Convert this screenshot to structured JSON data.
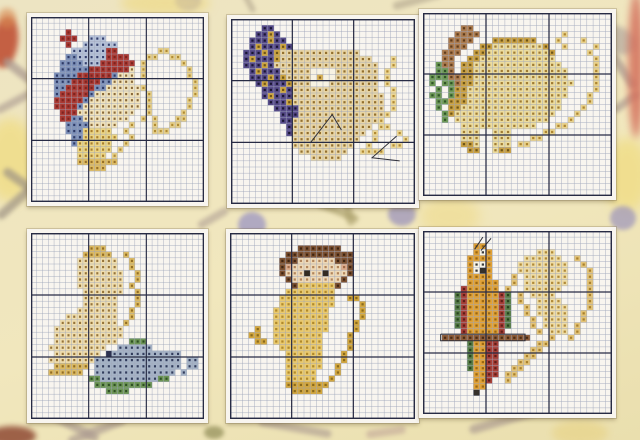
{
  "chart_style": {
    "paper": "#f8f5ef",
    "grid_thin": "#9aa2b8",
    "grid_thick": "#272b44",
    "backstitch": "#2f2f38"
  },
  "background": {
    "shapes": [
      {
        "kind": "ellipse",
        "x": -8,
        "y": 16,
        "w": 26,
        "h": 52,
        "rot": 8,
        "color": "#c05236",
        "op": 0.9,
        "blur": 3
      },
      {
        "kind": "ellipse",
        "x": -2,
        "y": 8,
        "w": 18,
        "h": 20,
        "rot": 0,
        "color": "#d88a52",
        "op": 0.6,
        "blur": 3
      },
      {
        "kind": "bar",
        "x": 0,
        "y": 66,
        "w": 36,
        "h": 9,
        "rot": 38,
        "color": "#a9988f",
        "op": 0.7,
        "blur": 2
      },
      {
        "kind": "bar",
        "x": -6,
        "y": 98,
        "w": 40,
        "h": 8,
        "rot": -28,
        "color": "#a9988f",
        "op": 0.6,
        "blur": 2
      },
      {
        "kind": "ellipse",
        "x": -16,
        "y": 118,
        "w": 52,
        "h": 84,
        "rot": 0,
        "color": "#f0dd85",
        "op": 0.8,
        "blur": 6
      },
      {
        "kind": "bar",
        "x": 0,
        "y": 178,
        "w": 44,
        "h": 9,
        "rot": 35,
        "color": "#9f9484",
        "op": 0.7,
        "blur": 2
      },
      {
        "kind": "bar",
        "x": -8,
        "y": 198,
        "w": 46,
        "h": 9,
        "rot": -42,
        "color": "#9f9484",
        "op": 0.7,
        "blur": 2
      },
      {
        "kind": "ellipse",
        "x": 175,
        "y": -8,
        "w": 26,
        "h": 18,
        "rot": 0,
        "color": "#9c94bb",
        "op": 0.8,
        "blur": 2
      },
      {
        "kind": "bar",
        "x": 232,
        "y": -4,
        "w": 30,
        "h": 6,
        "rot": 62,
        "color": "#b0a48c",
        "op": 0.6,
        "blur": 2
      },
      {
        "kind": "bar",
        "x": 392,
        "y": -4,
        "w": 52,
        "h": 8,
        "rot": -15,
        "color": "#b0a48c",
        "op": 0.6,
        "blur": 2
      },
      {
        "kind": "ellipse",
        "x": 120,
        "y": -10,
        "w": 90,
        "h": 26,
        "rot": 0,
        "color": "#eeda88",
        "op": 0.7,
        "blur": 5
      },
      {
        "kind": "ellipse",
        "x": 238,
        "y": 212,
        "w": 28,
        "h": 26,
        "rot": 0,
        "color": "#a19ac2",
        "op": 0.8,
        "blur": 2
      },
      {
        "kind": "ellipse",
        "x": 388,
        "y": 202,
        "w": 28,
        "h": 24,
        "rot": 0,
        "color": "#9c94bb",
        "op": 0.75,
        "blur": 2
      },
      {
        "kind": "bar",
        "x": 316,
        "y": 208,
        "w": 44,
        "h": 7,
        "rot": 22,
        "color": "#aba06c",
        "op": 0.65,
        "blur": 2
      },
      {
        "kind": "bar",
        "x": 344,
        "y": 194,
        "w": 8,
        "h": 32,
        "rot": -14,
        "color": "#aba06c",
        "op": 0.6,
        "blur": 2
      },
      {
        "kind": "bar",
        "x": 196,
        "y": 214,
        "w": 34,
        "h": 8,
        "rot": -30,
        "color": "#a9988f",
        "op": 0.55,
        "blur": 2
      },
      {
        "kind": "ellipse",
        "x": 420,
        "y": 196,
        "w": 60,
        "h": 40,
        "rot": 0,
        "color": "#eeda88",
        "op": 0.55,
        "blur": 6
      },
      {
        "kind": "ellipse",
        "x": 594,
        "y": 26,
        "w": 44,
        "h": 28,
        "rot": 18,
        "color": "#b0a49c",
        "op": 0.65,
        "blur": 3
      },
      {
        "kind": "bar",
        "x": 602,
        "y": 66,
        "w": 42,
        "h": 9,
        "rot": 55,
        "color": "#a9988f",
        "op": 0.7,
        "blur": 2
      },
      {
        "kind": "bar",
        "x": 610,
        "y": 98,
        "w": 32,
        "h": 8,
        "rot": -35,
        "color": "#a9988f",
        "op": 0.65,
        "blur": 2
      },
      {
        "kind": "ellipse",
        "x": 604,
        "y": 138,
        "w": 46,
        "h": 74,
        "rot": 0,
        "color": "#f0dd85",
        "op": 0.8,
        "blur": 6
      },
      {
        "kind": "ellipse",
        "x": 610,
        "y": 206,
        "w": 26,
        "h": 24,
        "rot": 0,
        "color": "#9c94bb",
        "op": 0.7,
        "blur": 2
      },
      {
        "kind": "ellipse",
        "x": 628,
        "y": -8,
        "w": 16,
        "h": 146,
        "rot": 0,
        "color": "#d4705c",
        "op": 0.85,
        "blur": 4
      },
      {
        "kind": "ellipse",
        "x": -12,
        "y": 426,
        "w": 48,
        "h": 20,
        "rot": 0,
        "color": "#8f4a34",
        "op": 0.85,
        "blur": 3
      },
      {
        "kind": "bar",
        "x": 38,
        "y": 420,
        "w": 64,
        "h": 9,
        "rot": 28,
        "color": "#a9988f",
        "op": 0.65,
        "blur": 2
      },
      {
        "kind": "bar",
        "x": 66,
        "y": 426,
        "w": 62,
        "h": 9,
        "rot": -22,
        "color": "#a9988f",
        "op": 0.65,
        "blur": 2
      },
      {
        "kind": "ellipse",
        "x": 204,
        "y": 426,
        "w": 20,
        "h": 13,
        "rot": 0,
        "color": "#95915c",
        "op": 0.75,
        "blur": 2
      },
      {
        "kind": "bar",
        "x": 258,
        "y": 424,
        "w": 74,
        "h": 8,
        "rot": 10,
        "color": "#a9988f",
        "op": 0.6,
        "blur": 2
      },
      {
        "kind": "bar",
        "x": 366,
        "y": 428,
        "w": 40,
        "h": 8,
        "rot": -8,
        "color": "#b89a92",
        "op": 0.5,
        "blur": 2
      },
      {
        "kind": "bar",
        "x": 468,
        "y": 416,
        "w": 72,
        "h": 9,
        "rot": -16,
        "color": "#a9988f",
        "op": 0.65,
        "blur": 2
      },
      {
        "kind": "ellipse",
        "x": 552,
        "y": 420,
        "w": 56,
        "h": 26,
        "rot": 0,
        "color": "#e8d48a",
        "op": 0.7,
        "blur": 4
      }
    ]
  },
  "panels": [
    {
      "subject": "red-and-blue-bird-with-golden-swirl",
      "cols": 30,
      "rows": 30,
      "box": {
        "left": 27,
        "top": 13,
        "width": 181,
        "height": 193
      },
      "palette": {
        "r": {
          "c": "#ab3a33",
          "s": "#7c2420"
        },
        "l": {
          "c": "#b6c2d8",
          "s": "#35406e"
        },
        "b": {
          "c": "#7d90b8",
          "s": "#2e3a66"
        },
        "c": {
          "c": "#f2e4bc",
          "s": "#8a6a3a"
        },
        "y": {
          "c": "#ecd584",
          "s": "#a87f2e"
        },
        "g": {
          "c": "#e6cf8a",
          "s": "#b08b33"
        },
        "f": {
          "c": "#dfbc62",
          "s": "#97702a"
        }
      },
      "grid": [
        "..............................",
        "..............................",
        "......r.......................",
        ".....rrr..lll.................",
        "......r..llllll...............",
        ".......llllllrr.......gg......",
        "......bblllllrrrr...gg..gg....",
        ".....bbbblllrrrrrr.g......g...",
        ".....bbbbbrrrrrrrc.g.......g..",
        "....bbbbrrrrrrbccc.g.......g..",
        "....bbbrrrrrbbcccc..........g.",
        "....bbrrrrrbbccccccg........g.",
        "....brrrrrbcccccccc.g.......g.",
        "....rrrrrbccccccccc.g......g..",
        "....rrrrbcccccccccc.g......g..",
        ".....rrrcccccccccc..g.....g...",
        ".....rrbbcccccccc..g.g...gg...",
        "......bbbbccccc..g...g..gg....",
        "......bbbyyyyy..g....ggg......",
        ".......bbyyyyyy..g............",
        ".......byyyyyy..g.............",
        "........yyyyyy.g..............",
        "........yyyyy.g...............",
        "........fffffff...............",
        "..........fff.................",
        "..............................",
        "..............................",
        "..............................",
        "..............................",
        ".............................."
      ],
      "backstitch": []
    },
    {
      "subject": "purple-headed-fish",
      "cols": 30,
      "rows": 30,
      "box": {
        "left": 227,
        "top": 15,
        "width": 192,
        "height": 193
      },
      "palette": {
        "p": {
          "c": "#564a88",
          "s": "#191633"
        },
        "a": {
          "c": "#cda43f",
          "s": "#6e5517"
        },
        "e": {
          "c": "#e9d6a6",
          "s": "#93702f"
        },
        "o": {
          "c": "#ecd795",
          "s": "#b18a34"
        },
        "w": {
          "c": "#f7f2e2",
          "s": null
        },
        "d": {
          "c": "#d9b254",
          "s": "#8a6420"
        }
      },
      "grid": [
        "..............................",
        ".....pp.......................",
        "....ppap......................",
        "...pppapp.....................",
        "...papppap....................",
        "..pppapaeeeeeeeeeeeee.........",
        "..papppaeeeeeeeeeeeeeee...o...",
        "..pppapeeeeeeeeeeeeeeeee..o...",
        "...papppeeeeewwwweeeeeee.o....",
        "...pppapaeeeewdwweeeeeee.o....",
        "....papppaeeewwweeeeeeee.o....",
        ".....pppapeeeeeeeeeeeeee..o...",
        ".....papppeeeeeeeeeeeeeee.o...",
        "......pppaeeeeeeeeeeeeeee.o...",
        ".......ppppeeeeeeeeeeeeee.o...",
        "........pppeeeeeeeeeeeeeeo....",
        "........ppeeeeeeeeeeeeeeo.....",
        ".........peeeeeeeeeeeee.oo....",
        ".........peeeeeeeeeeee.o...o..",
        "..........eeeeeeeeeee..o....o.",
        "..........eeeeeeeeee..o...oo..",
        "...........eeeeeeee..oooo.....",
        ".............eeeee............",
        "..............................",
        "..............................",
        "..............................",
        "..............................",
        "..............................",
        "..............................",
        ".............................."
      ],
      "backstitch": [
        [
          [
            13,
            20
          ],
          [
            16.5,
            15.5
          ],
          [
            18,
            18
          ]
        ],
        [
          [
            27,
            19
          ],
          [
            23,
            22.5
          ],
          [
            27.5,
            23
          ]
        ]
      ]
    },
    {
      "subject": "grazing-animal-with-green-plant-and-swirl",
      "cols": 30,
      "rows": 30,
      "box": {
        "left": 419,
        "top": 9,
        "width": 197,
        "height": 191
      },
      "palette": {
        "m": {
          "c": "#ad7c4e",
          "s": "#5f3c1c"
        },
        "d": {
          "c": "#caa143",
          "s": "#6e5517"
        },
        "h": {
          "c": "#ecdc9e",
          "s": "#a07c33"
        },
        "g": {
          "c": "#6f9a58",
          "s": "#2f5426"
        },
        "o": {
          "c": "#e9d28d",
          "s": "#ad8530"
        }
      },
      "grid": [
        "..............................",
        "..............................",
        "......mm......................",
        ".....mmmm.............o.......",
        "....mmmm...ddddddd...o...o....",
        "....mmm..ddhhhhhhhhd..o....o..",
        "...mmm..ddhhhhhhhhhhd.....o...",
        "...mm..ddhhhhhhhhhhhh......o..",
        "..gmm.ddhhhhhhhhhhhhhh.....o..",
        "..ggm.ddhhhhhhhhhhhhhhh....o..",
        ".gggmmddhhhhhhhhhhhhhhh....o..",
        ".g.ggmddhhhhhhhhhhhhhhhh...o..",
        "..g.gddhhhhhhhhhhhhhhhh....o..",
        ".gg.gddhhhhhhhhhhhhhhhh...o...",
        "..ggdddhhhhhhhhhhhhhhh....o...",
        "..g.ddhhhhhhhhhhhhhhhh...o....",
        "...gdhhhhhhhhhhhhhhhh...o.....",
        "...g.hhhhhhhhhhhhhhh...o......",
        "......hhhhhhhhhhhh...oo.......",
        "......hhh..hhh.....oo.........",
        "......hhh..hhh...oo...........",
        "......ddh..hhh.oo.............",
        ".......dd..hdd................",
        "..............................",
        "..............................",
        "..............................",
        "..............................",
        "..............................",
        "..............................",
        ".............................."
      ],
      "backstitch": []
    },
    {
      "subject": "cream-bird-with-blue-fish-on-green-weed",
      "cols": 30,
      "rows": 30,
      "box": {
        "left": 27,
        "top": 229,
        "width": 181,
        "height": 194
      },
      "palette": {
        "c": {
          "c": "#f0deae",
          "s": "#96743a"
        },
        "d": {
          "c": "#dcba62",
          "s": "#926d24"
        },
        "s": {
          "c": "#a5b3c6",
          "s": "#323c5c"
        },
        "g": {
          "c": "#6d9556",
          "s": "#2e4f24"
        },
        "w": {
          "c": "#f8f6ee",
          "s": null
        },
        "k": {
          "c": "#2c3150",
          "s": null
        }
      },
      "grid": [
        "..............................",
        "..............................",
        "..........ddd.................",
        ".........ddddd..d.............",
        "........ccccccc..d............",
        "........ccccccc..d............",
        "........cccccccc..d...........",
        "........cccccccc..d...........",
        "........cccccccc.d............",
        ".........ccccccc..d...........",
        ".........cccccc...d...........",
        ".........cccccc...d...........",
        "........ccccccc..d............",
        "......ccccccccc..d............",
        ".....cccccccccc.d.............",
        "....cccccccccccc..............",
        "....cccccccccccc..............",
        "....ccccccccccc..ggg..........",
        "...cccccccccc..ssssss.........",
        "....ccccccccwkssssssssssss....",
        "...ccccccccsssssssssssssss.ss.",
        "....dddddd.sssssssssssssss.ss.",
        "...dddddd..ssssssssssssss.s...",
        "..........ggssssssssssgg......",
        "...........gggggggggg.........",
        ".............gggg.............",
        "..............................",
        "..............................",
        "..............................",
        ".............................."
      ],
      "backstitch": []
    },
    {
      "subject": "monkey-with-curled-tail",
      "cols": 30,
      "rows": 30,
      "box": {
        "left": 226,
        "top": 229,
        "width": 193,
        "height": 194
      },
      "palette": {
        "b": {
          "c": "#7d5130",
          "s": "#3e2412"
        },
        "f": {
          "c": "#efd9b6",
          "s": "#b2855c"
        },
        "p": {
          "c": "#dcab8b",
          "s": "#a06a48"
        },
        "y": {
          "c": "#eaca6e",
          "s": "#b18a2c"
        },
        "d": {
          "c": "#d3a73e",
          "s": "#8a6a1d"
        },
        "k": {
          "c": "#332b22",
          "s": null
        }
      },
      "grid": [
        "..............................",
        "..............................",
        "...........bbbbbbb...........",
        ".........bbbbbbbbbbb..........",
        "........bbbffffffbbb..........",
        "........bpffffffffpb..........",
        "........bfffkffkfffb..........",
        ".........bffffffffb...........",
        "..........byyyyyyb............",
        ".........yyyyyyyy.............",
        "........yyyyyyyyy..dd.........",
        "........yyyyyyyyy....d........",
        ".......yyyyyyyyy.....d........",
        ".......yyyyyyyyy.....d........",
        ".......yyyyyyyyy....d.........",
        "....d..yyyyyyyyy....d.........",
        "...dd..yyyyyyyy....d..........",
        "....dd.yyyyyyyy....d..........",
        "........yyyyyyy....d..........",
        ".........yyyyyy...d...........",
        ".........yyyyyy...d...........",
        ".........yyyyyy..d............",
        ".........yyyyy...d............",
        ".........yyyyy..d.............",
        ".........ddddddd..............",
        "..........ddddd...............",
        "..............................",
        "..............................",
        "..............................",
        ".............................."
      ],
      "backstitch": []
    },
    {
      "subject": "parrot-on-perch-with-pale-wing-swirl",
      "cols": 30,
      "rows": 30,
      "box": {
        "left": 419,
        "top": 227,
        "width": 197,
        "height": 191
      },
      "palette": {
        "o": {
          "c": "#e0a238",
          "s": "#9a6712"
        },
        "r": {
          "c": "#a84038",
          "s": "#5e1d18"
        },
        "g": {
          "c": "#597e49",
          "s": "#27421e"
        },
        "n": {
          "c": "#8d5c38",
          "s": "#4a2b14"
        },
        "h": {
          "c": "#eedca6",
          "s": "#b08a38"
        },
        "d": {
          "c": "#e3c377",
          "s": "#a9802c"
        },
        "w": {
          "c": "#f8f4e6",
          "s": "#3a3a3a"
        },
        "k": {
          "c": "#35302a",
          "s": null
        }
      },
      "grid": [
        "..............................",
        "..............................",
        "........oo....................",
        "........owo.......hhh.........",
        ".......oooo.....hhhhhh..d.....",
        ".......owwo....hhhhhhhh..d....",
        ".......owko....hhhhhhhh...d...",
        ".......oooo...d.hhhhhhh...d...",
        ".......ooooo..d.hhhhhhh...d...",
        "......rooooo.d..hhhhhh....d...",
        ".....grooooorg.d.hhhh.....d...",
        ".....grooooorg.d..hhhh....d...",
        ".....grooooorg..d.hhhhh...d...",
        ".....grooooorg..d.hhhhh..d....",
        ".....grooooorg...d.hhhh..d....",
        ".....grooooorg...d.hhhh.d.....",
        "......rooooor.....d.hhh.d.....",
        "...nnnnnnnnnnnnnn...d..d......",
        ".......goorr......dd..........",
        ".......goorr.....dd...........",
        ".......goorr....dd............",
        ".......goorr...dd.............",
        ".......goorr..dd..............",
        "........oorr.dd...............",
        "........oor..d................",
        "........oo....................",
        "........k.....................",
        "..............................",
        "..............................",
        ".............................."
      ],
      "backstitch": [
        [
          [
            9.2,
            3.2
          ],
          [
            10.8,
            1.2
          ]
        ],
        [
          [
            8.2,
            3.0
          ],
          [
            9.5,
            1.0
          ]
        ],
        [
          [
            2.8,
            16.9
          ],
          [
            16.2,
            16.9
          ],
          [
            16.2,
            18.0
          ],
          [
            2.8,
            18.0
          ],
          [
            2.8,
            16.9
          ]
        ]
      ]
    }
  ]
}
